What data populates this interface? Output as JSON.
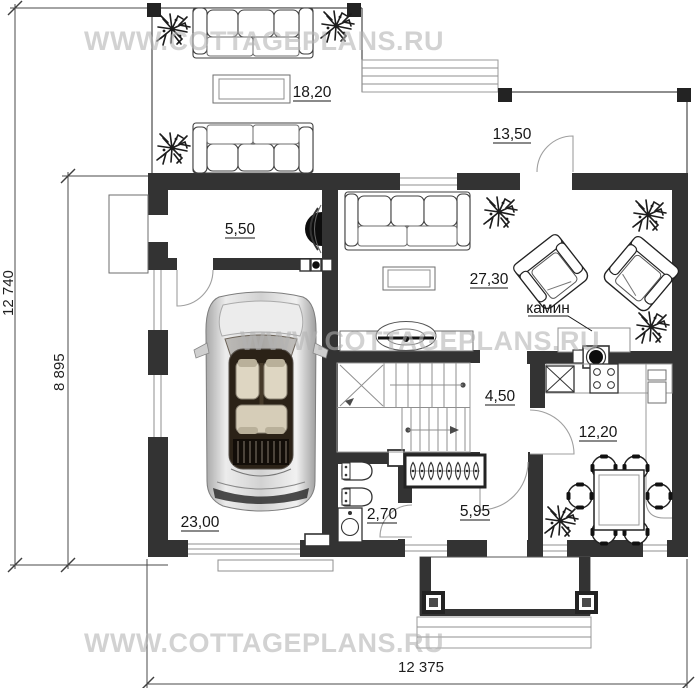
{
  "watermarks": {
    "top": "WWW.COTTAGEPLANS.RU",
    "middle": "WWW.COTTAGEPLANS.RU",
    "bottom": "WWW.COTTAGEPLANS.RU"
  },
  "dimensions": {
    "left_outer": "12 740",
    "left_inner": "8 895",
    "bottom": "12 375"
  },
  "rooms": [
    {
      "id": "terrace-top",
      "area": "18,20"
    },
    {
      "id": "terrace-side",
      "area": "13,50"
    },
    {
      "id": "boiler-room",
      "area": "5,50"
    },
    {
      "id": "living-room",
      "area": "27,30"
    },
    {
      "id": "stair-hall",
      "area": "4,50"
    },
    {
      "id": "kitchen",
      "area": "12,20"
    },
    {
      "id": "garage",
      "area": "23,00"
    },
    {
      "id": "bathroom",
      "area": "2,70"
    },
    {
      "id": "entry-hall",
      "area": "5,95"
    }
  ],
  "annotations": {
    "fireplace_label": "камин"
  },
  "colors": {
    "walls": "#333333",
    "posts": "#232323",
    "furniture_line": "#3f3f3f",
    "dimension_text": "#1f1f1f",
    "watermark": "#b3b3b3",
    "car_body": "#d8d8d8",
    "car_glass": "#2b2217",
    "fixture_black": "#0d0d0d"
  }
}
